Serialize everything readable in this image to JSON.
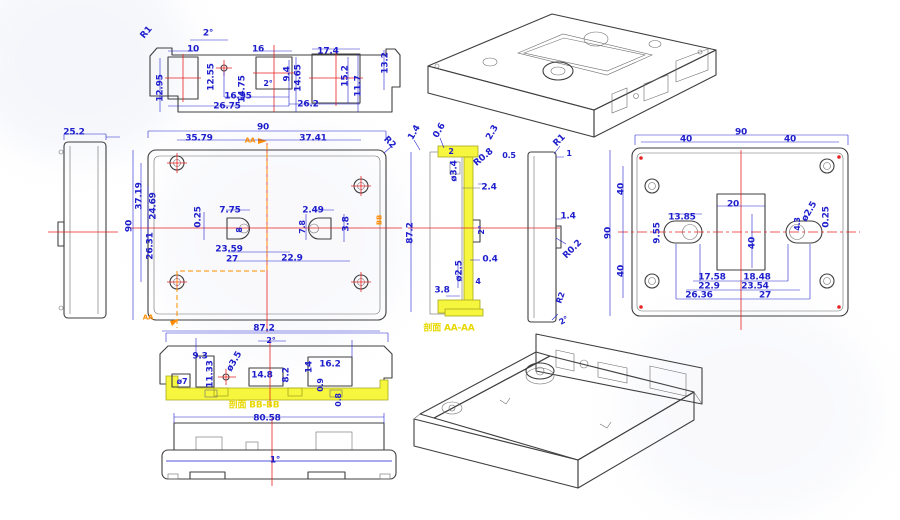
{
  "drawing": {
    "kind": "engineering-cad-multiview-enclosure",
    "background": "#ffffff",
    "colors": {
      "dimension": "#1e1ecc",
      "outline": "#3f3f3f",
      "centerline": "#e82323",
      "section_marker": "#ff8c00",
      "section_highlight": "#f6f63e",
      "section_title": "#e8d800"
    },
    "section_titles": {
      "aa": "剖面 AA-AA",
      "bb": "剖面 BB-BB"
    },
    "views": [
      {
        "name": "front-elevation-top-left"
      },
      {
        "name": "isometric-top-right"
      },
      {
        "name": "left-side-view"
      },
      {
        "name": "top-view-center"
      },
      {
        "name": "section-aa"
      },
      {
        "name": "right-side-small-view"
      },
      {
        "name": "bottom-face-view-right"
      },
      {
        "name": "section-bb"
      },
      {
        "name": "bottom-elevation"
      },
      {
        "name": "isometric-tray-bottom-right"
      }
    ]
  },
  "labels": [
    {
      "t": "R1",
      "x": 147,
      "y": 33,
      "r": -50
    },
    {
      "t": "2°",
      "x": 208,
      "y": 34
    },
    {
      "t": "10",
      "x": 193,
      "y": 50
    },
    {
      "t": "12.55",
      "x": 212,
      "y": 77,
      "r": -90
    },
    {
      "t": "12.95",
      "x": 161,
      "y": 88,
      "r": -90
    },
    {
      "t": "16",
      "x": 258,
      "y": 50
    },
    {
      "t": "9.4",
      "x": 288,
      "y": 74,
      "r": -90
    },
    {
      "t": "2°",
      "x": 268,
      "y": 84,
      "s": 8
    },
    {
      "t": "14.75",
      "x": 243,
      "y": 89,
      "r": -90
    },
    {
      "t": "14.65",
      "x": 299,
      "y": 78,
      "r": -90
    },
    {
      "t": "17.4",
      "x": 328,
      "y": 52
    },
    {
      "t": "15.2",
      "x": 346,
      "y": 76,
      "r": -90
    },
    {
      "t": "11.7",
      "x": 359,
      "y": 86,
      "r": -90
    },
    {
      "t": "13.2",
      "x": 386,
      "y": 63,
      "r": -90
    },
    {
      "t": "16.95",
      "x": 238,
      "y": 97
    },
    {
      "t": "26.75",
      "x": 227,
      "y": 107
    },
    {
      "t": "26.2",
      "x": 308,
      "y": 105
    },
    {
      "t": "25.2",
      "x": 74,
      "y": 133
    },
    {
      "t": "90",
      "x": 263,
      "y": 128
    },
    {
      "t": "35.79",
      "x": 199,
      "y": 139
    },
    {
      "t": "37.41",
      "x": 313,
      "y": 139
    },
    {
      "t": "R2",
      "x": 389,
      "y": 143,
      "r": 45
    },
    {
      "t": "AA",
      "x": 250,
      "y": 141,
      "c": "orange",
      "s": 7
    },
    {
      "t": "37.19",
      "x": 140,
      "y": 196,
      "r": -90
    },
    {
      "t": "24.69",
      "x": 154,
      "y": 206,
      "r": -90
    },
    {
      "t": "90",
      "x": 130,
      "y": 226,
      "r": -90
    },
    {
      "t": "26.31",
      "x": 151,
      "y": 246,
      "r": -90
    },
    {
      "t": "0.25",
      "x": 199,
      "y": 217,
      "r": -90
    },
    {
      "t": "7.75",
      "x": 230,
      "y": 211
    },
    {
      "t": "8",
      "x": 240,
      "y": 230,
      "r": -90,
      "s": 8
    },
    {
      "t": "23.59",
      "x": 229,
      "y": 250
    },
    {
      "t": "27",
      "x": 232,
      "y": 260
    },
    {
      "t": "22.9",
      "x": 292,
      "y": 259
    },
    {
      "t": "2.49",
      "x": 313,
      "y": 211
    },
    {
      "t": "7.8",
      "x": 303,
      "y": 227,
      "r": -90,
      "s": 8
    },
    {
      "t": "3.8",
      "x": 347,
      "y": 224,
      "r": -90
    },
    {
      "t": "BB",
      "x": 380,
      "y": 220,
      "r": -90,
      "c": "orange",
      "s": 7
    },
    {
      "t": "AA",
      "x": 148,
      "y": 318,
      "c": "orange",
      "s": 7
    },
    {
      "t": "87.2",
      "x": 264,
      "y": 329
    },
    {
      "t": "1.4",
      "x": 415,
      "y": 133,
      "r": -60
    },
    {
      "t": "0.6",
      "x": 440,
      "y": 131,
      "r": -60
    },
    {
      "t": "2",
      "x": 451,
      "y": 152,
      "s": 8
    },
    {
      "t": "ø3.4",
      "x": 455,
      "y": 171,
      "r": -90
    },
    {
      "t": "R0.8",
      "x": 484,
      "y": 158,
      "r": -40
    },
    {
      "t": "2.4",
      "x": 489,
      "y": 188
    },
    {
      "t": "2.3",
      "x": 493,
      "y": 133,
      "r": -60
    },
    {
      "t": "0.5",
      "x": 509,
      "y": 156,
      "s": 8
    },
    {
      "t": "87.2",
      "x": 411,
      "y": 233,
      "r": -90
    },
    {
      "t": "2°",
      "x": 482,
      "y": 230,
      "r": -90,
      "s": 8
    },
    {
      "t": "0.4",
      "x": 490,
      "y": 260
    },
    {
      "t": "ø2.5",
      "x": 460,
      "y": 271,
      "r": -90
    },
    {
      "t": "3.8",
      "x": 442,
      "y": 291
    },
    {
      "t": "4",
      "x": 478,
      "y": 282,
      "s": 8
    },
    {
      "t": "剖面 AA-AA",
      "x": 449,
      "y": 329,
      "c": "yellow"
    },
    {
      "t": "R1",
      "x": 560,
      "y": 141,
      "r": -45
    },
    {
      "t": "1",
      "x": 569,
      "y": 154,
      "s": 8
    },
    {
      "t": "1.4",
      "x": 568,
      "y": 217
    },
    {
      "t": "R0.2",
      "x": 573,
      "y": 250,
      "r": -45
    },
    {
      "t": "R2",
      "x": 561,
      "y": 298,
      "r": -70,
      "s": 8
    },
    {
      "t": "2°",
      "x": 564,
      "y": 321,
      "r": -30,
      "s": 8
    },
    {
      "t": "90",
      "x": 741,
      "y": 133
    },
    {
      "t": "40",
      "x": 686,
      "y": 140
    },
    {
      "t": "40",
      "x": 790,
      "y": 140
    },
    {
      "t": "90",
      "x": 609,
      "y": 233,
      "r": -90
    },
    {
      "t": "40",
      "x": 622,
      "y": 189,
      "r": -90
    },
    {
      "t": "40",
      "x": 622,
      "y": 271,
      "r": -90
    },
    {
      "t": "20",
      "x": 733,
      "y": 205
    },
    {
      "t": "40",
      "x": 753,
      "y": 243,
      "r": -90
    },
    {
      "t": "13.85",
      "x": 682,
      "y": 218
    },
    {
      "t": "9.55",
      "x": 658,
      "y": 233,
      "r": -90
    },
    {
      "t": "ø2.5",
      "x": 810,
      "y": 212,
      "r": -60
    },
    {
      "t": "4.3",
      "x": 798,
      "y": 224,
      "r": -90,
      "s": 8
    },
    {
      "t": "0.25",
      "x": 827,
      "y": 217,
      "r": -90
    },
    {
      "t": "17.58",
      "x": 712,
      "y": 278
    },
    {
      "t": "18.48",
      "x": 757,
      "y": 278
    },
    {
      "t": "22.9",
      "x": 709,
      "y": 287
    },
    {
      "t": "23.54",
      "x": 755,
      "y": 287
    },
    {
      "t": "26.36",
      "x": 699,
      "y": 296
    },
    {
      "t": "27",
      "x": 765,
      "y": 296
    },
    {
      "t": "2°",
      "x": 271,
      "y": 341,
      "s": 8
    },
    {
      "t": "9.3",
      "x": 200,
      "y": 357
    },
    {
      "t": "11.33",
      "x": 211,
      "y": 374,
      "r": -90
    },
    {
      "t": "ø3.5",
      "x": 235,
      "y": 362,
      "r": -60
    },
    {
      "t": "ø7",
      "x": 182,
      "y": 382,
      "s": 8
    },
    {
      "t": "14.8",
      "x": 262,
      "y": 376
    },
    {
      "t": "8.2",
      "x": 287,
      "y": 375,
      "r": -90
    },
    {
      "t": "14",
      "x": 310,
      "y": 367,
      "r": -90
    },
    {
      "t": "16.2",
      "x": 330,
      "y": 365
    },
    {
      "t": "0.9",
      "x": 321,
      "y": 385,
      "r": -90,
      "s": 8
    },
    {
      "t": "0.8",
      "x": 339,
      "y": 400,
      "r": -90,
      "s": 8
    },
    {
      "t": "剖面 BB-BB",
      "x": 254,
      "y": 406,
      "c": "yellow"
    },
    {
      "t": "80.58",
      "x": 267,
      "y": 419
    },
    {
      "t": "1°",
      "x": 275,
      "y": 461
    }
  ]
}
